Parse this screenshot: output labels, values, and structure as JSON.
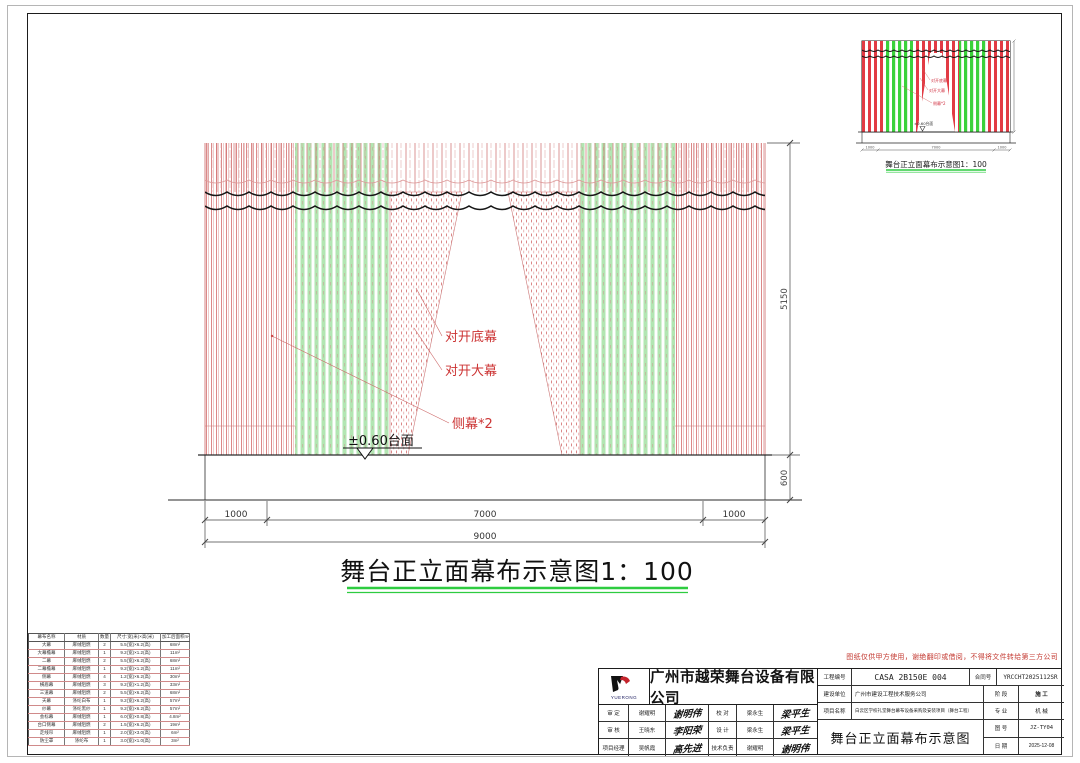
{
  "main_drawing": {
    "title": "舞台正立面幕布示意图1：100",
    "labels": {
      "bottom_curtain": "对开底幕",
      "main_curtain": "对开大幕",
      "side_curtain": "侧幕*2",
      "stage_datum": "±0.60台面"
    },
    "dims": {
      "left": "1000",
      "center": "7000",
      "right": "1000",
      "total": "9000",
      "curtain_height": "5150",
      "stage_height": "600"
    }
  },
  "preview": {
    "caption": "舞台正立面幕布示意图1：100",
    "labels": [
      "对开底幕",
      "对开大幕",
      "侧幕*2"
    ],
    "datum": "±0.60台面",
    "dims": [
      "1000",
      "7000",
      "1000"
    ]
  },
  "parts_table": {
    "headers": [
      "幕布名称",
      "材质",
      "数量",
      "尺寸:宽(米)×高(米)",
      "加工后面积m²"
    ],
    "rows": [
      [
        "大幕",
        "麻绒阻燃",
        "2",
        "5.5(宽)×6.2(高)",
        "68m²"
      ],
      [
        "大幕檐幕",
        "麻绒阻燃",
        "1",
        "9.2(宽)×1.2(高)",
        "11m²"
      ],
      [
        "二幕",
        "麻绒阻燃",
        "2",
        "5.5(宽)×6.2(高)",
        "68m²"
      ],
      [
        "二幕檐幕",
        "麻绒阻燃",
        "1",
        "9.2(宽)×1.2(高)",
        "11m²"
      ],
      [
        "侧幕",
        "麻绒阻燃",
        "4",
        "1.2(宽)×6.2(高)",
        "30m²"
      ],
      [
        "横眉幕",
        "麻绒阻燃",
        "3",
        "9.2(宽)×1.2(高)",
        "33m²"
      ],
      [
        "三道幕",
        "麻绒阻燃",
        "2",
        "5.5(宽)×6.2(高)",
        "68m²"
      ],
      [
        "天幕",
        "涤纶白布",
        "1",
        "9.2(宽)×6.2(高)",
        "57m²"
      ],
      [
        "纱幕",
        "涤纶黑纱",
        "1",
        "9.2(宽)×6.2(高)",
        "57m²"
      ],
      [
        "会标幕",
        "麻绒阻燃",
        "1",
        "6.0(宽)×0.8(高)",
        "4.8m²"
      ],
      [
        "台口侧幕",
        "麻绒阻燃",
        "2",
        "1.5(宽)×6.2(高)",
        "19m²"
      ],
      [
        "走线帘",
        "麻绒阻燃",
        "1",
        "2.0(宽)×3.0(高)",
        "6m²"
      ],
      [
        "防尘罩",
        "涤纶布",
        "1",
        "3.0(宽)×1.0(高)",
        "3m²"
      ]
    ]
  },
  "title_block": {
    "disclaimer": "图纸仅供甲方使用，谢绝翻印或借阅，不得将文件转给第三方公司",
    "company": "广州市越荣舞台设备有限公司",
    "logo_text": "YUERONG",
    "fields": {
      "project_no_label": "工程编号",
      "project_no": "CASA 2B150E 004",
      "contract_label": "合同号",
      "contract_no": "YRCCHT2025112SR",
      "client_label": "建设单位",
      "client": "广州市建设工程技术服务公司",
      "project_label": "项目名称",
      "project": "白云区学校礼堂舞台幕布设备采购及安装项目（舞台工程）",
      "stage_label": "阶 段",
      "stage": "施 工",
      "specialty_label": "专 业",
      "specialty": "机 械",
      "drawing_no_label": "图 号",
      "drawing_no": "JZ-TY04",
      "date_label": "日 期",
      "date": "2025-12-08",
      "drawing_title": "舞台正立面幕布示意图"
    },
    "signatures": [
      [
        "审 定",
        "谢耀明",
        "谢明伟",
        "校 对",
        "梁永生",
        "梁平生"
      ],
      [
        "审 核",
        "王晓东",
        "李阳荣",
        "设 计",
        "梁永生",
        "梁平生"
      ],
      [
        "项目经理",
        "吴帆霞",
        "高先进",
        "技术负责",
        "谢耀明",
        "谢明伟"
      ]
    ]
  },
  "colors": {
    "red_line": "#cc5555",
    "green_stripe": "#b2e6b2",
    "mini_red": "#e23b44",
    "mini_green": "#3bd23b",
    "underline_green": "#2ecc40",
    "label_red": "#cc3333"
  }
}
